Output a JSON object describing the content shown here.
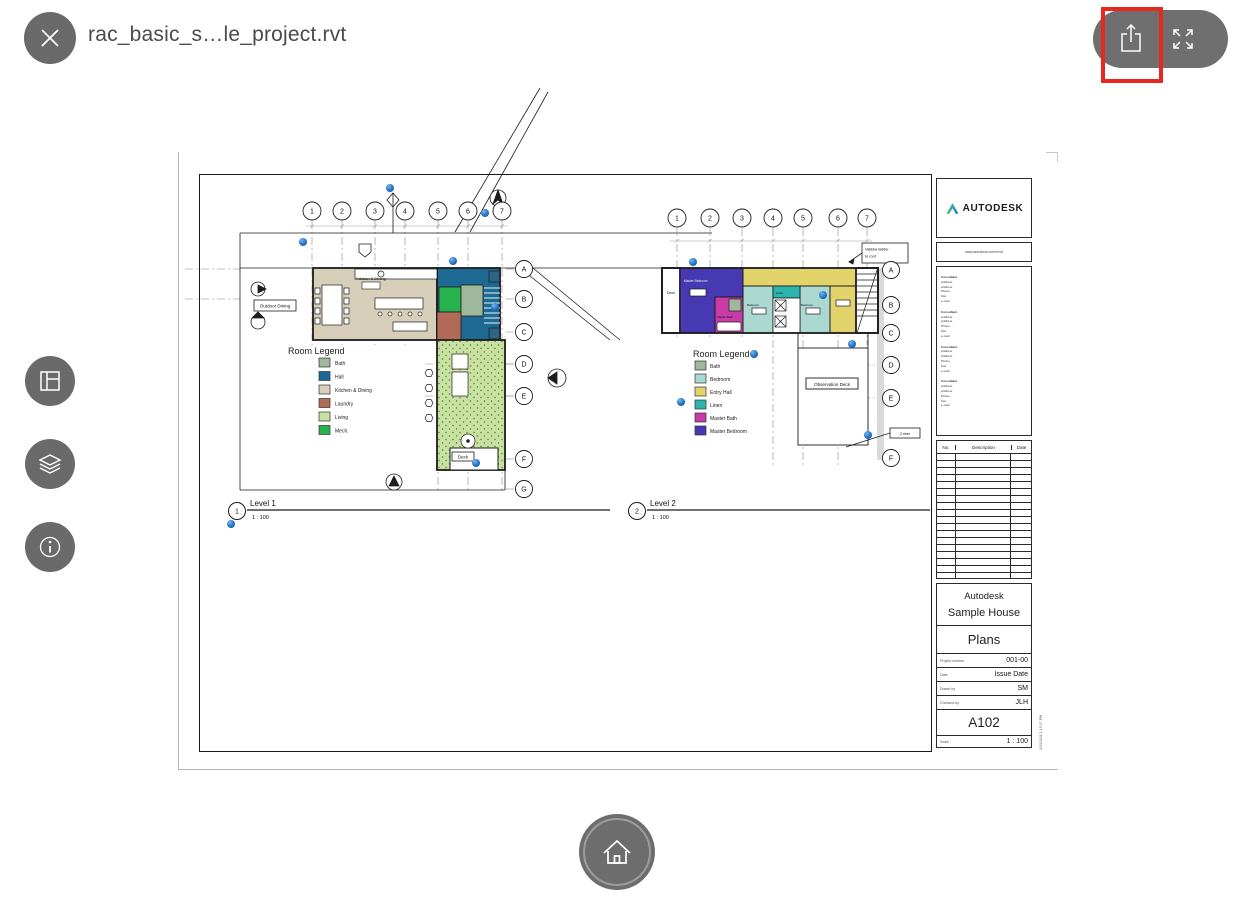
{
  "header": {
    "filename": "rac_basic_s…le_project.rvt",
    "highlight_color": "#e7281e"
  },
  "annotation_marker_color": "#2f7fd6",
  "sheet": {
    "grid": {
      "columns": [
        "1",
        "2",
        "3",
        "4",
        "5",
        "6",
        "7"
      ],
      "rows": [
        "A",
        "B",
        "C",
        "D",
        "E",
        "F",
        "G"
      ]
    },
    "views": [
      {
        "number": "1",
        "title": "Level 1",
        "scale": "1 : 100",
        "room_legend": {
          "title": "Room Legend",
          "items": [
            {
              "label": "Bath",
              "color": "#9fb79b"
            },
            {
              "label": "Hall",
              "color": "#1c6a93"
            },
            {
              "label": "Kitchen & Dining",
              "color": "#d8cfba"
            },
            {
              "label": "Laundry",
              "color": "#b26a58"
            },
            {
              "label": "Living",
              "color": "#c8e0a0"
            },
            {
              "label": "Mech.",
              "color": "#29b34e"
            }
          ]
        },
        "labels": {
          "outdoor_dining": "Outdoor Dining",
          "kitchen_dining": "Kitchen & Dining",
          "deck": "Deck"
        }
      },
      {
        "number": "2",
        "title": "Level 2",
        "scale": "1 : 100",
        "room_legend": {
          "title": "Room Legend",
          "items": [
            {
              "label": "Bath",
              "color": "#9fb79b"
            },
            {
              "label": "Bedroom",
              "color": "#abd9d2"
            },
            {
              "label": "Entry Hall",
              "color": "#e2d36b"
            },
            {
              "label": "Linen",
              "color": "#2db4aa"
            },
            {
              "label": "Master Bath",
              "color": "#c93ba6"
            },
            {
              "label": "Master Bedroom",
              "color": "#4739b2"
            }
          ]
        },
        "labels": {
          "deck": "Deck",
          "master_bedroom": "Master Bedroom",
          "master_bath": "Master Bath",
          "bedroom": "Bedroom",
          "linen": "Linen",
          "observation_deck": "Observation Deck",
          "ladder_note_line1": "Valikka ladder",
          "ladder_note_line2": "to roof",
          "riser_note": "2 riser"
        }
      }
    ],
    "titleblock": {
      "brand": "AUTODESK",
      "website": "www.autodesk.com/revit",
      "consultant_lines": [
        "Consultant",
        "Address",
        "Address",
        "Phone",
        "Fax",
        "e-mail"
      ],
      "revision_table": {
        "headers": [
          "No.",
          "Description",
          "Date"
        ],
        "empty_rows": 18
      },
      "client": "Autodesk",
      "project_name": "Sample House",
      "sheet_title": "Plans",
      "fields": [
        {
          "label": "Project number",
          "value": "001-00"
        },
        {
          "label": "Date",
          "value": "Issue Date"
        },
        {
          "label": "Drawn by",
          "value": "SM"
        },
        {
          "label": "Checked by",
          "value": "JLH"
        }
      ],
      "sheet_number": "A102",
      "scale_label": "Scale",
      "scale_value": "1 : 100",
      "plot_stamp": "3/31/2011 1:15:37 PM"
    }
  }
}
